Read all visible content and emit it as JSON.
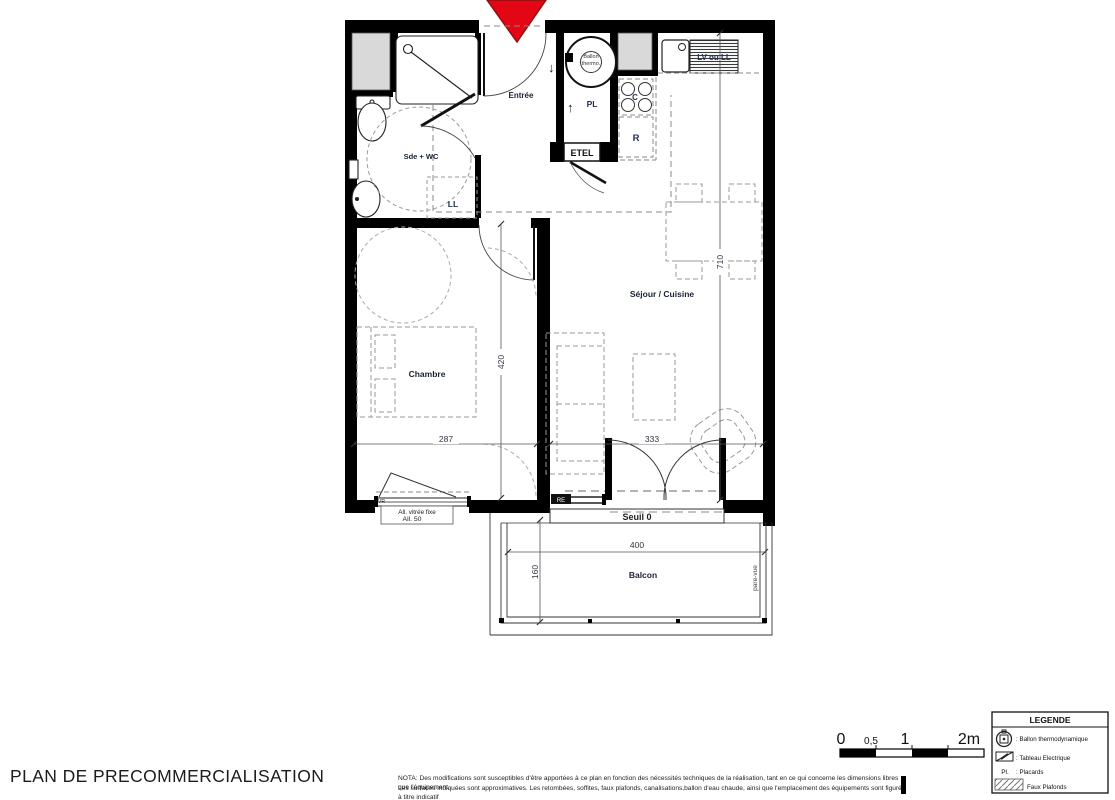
{
  "page": {
    "title": "PLAN DE PRECOMMERCIALISATION",
    "nota_line1": "NOTA:  Des modifications sont susceptibles d'être apportées à ce plan en fonction des nécessités techniques de la réalisation, tant en ce qui concerne les dimensions libres que l'équipement.",
    "nota_line2": "Les surfaces indiquées sont approximatives. Les retombées, soffites, faux plafonds, canalisations,ballon d'eau chaude, ainsi que l'emplacement des équipements sont figurés à titre indicatif"
  },
  "plan": {
    "rooms": {
      "entree": "Entrée",
      "sde_wc": "Sde + WC",
      "chambre": "Chambre",
      "sejour_cuisine": "Séjour / Cuisine",
      "balcon": "Balcon"
    },
    "annotations": {
      "ballon_line1": "Ballon",
      "ballon_line2": "thermo.",
      "pl": "PL",
      "etel": "ETEL",
      "cooktop_c": "C",
      "fridge_r": "R",
      "washer_ll": "LL",
      "lv_ou_ll": "LV ou LL",
      "vr": "VR",
      "re": "RE",
      "seuil": "Seuil 0",
      "allege_vitree": "All. vitrée fixe",
      "allege_50": "All. 50",
      "pare_vue": "pare-vue",
      "arrow_up": "↑",
      "arrow_down": "↓"
    },
    "dimensions": {
      "chambre_width": "287",
      "chambre_depth": "420",
      "sejour_width": "333",
      "sejour_depth": "710",
      "balcon_width": "400",
      "balcon_depth": "160"
    }
  },
  "scale_bar": {
    "t0": "0",
    "t05": "0,5",
    "t1": "1",
    "t2": "2m"
  },
  "legend": {
    "title": "LEGENDE",
    "items": [
      {
        "label": ": Ballon thermodynamique"
      },
      {
        "label": ": Tableau Electrique"
      },
      {
        "symbol": "Pl.",
        "label": ": Placards"
      },
      {
        "label": "Faux Plafonds"
      }
    ]
  },
  "colors": {
    "arrow_red": "#e30615",
    "wall": "#000000",
    "duct_gray": "#d9d9d9",
    "label_navy": "#1a2133"
  }
}
